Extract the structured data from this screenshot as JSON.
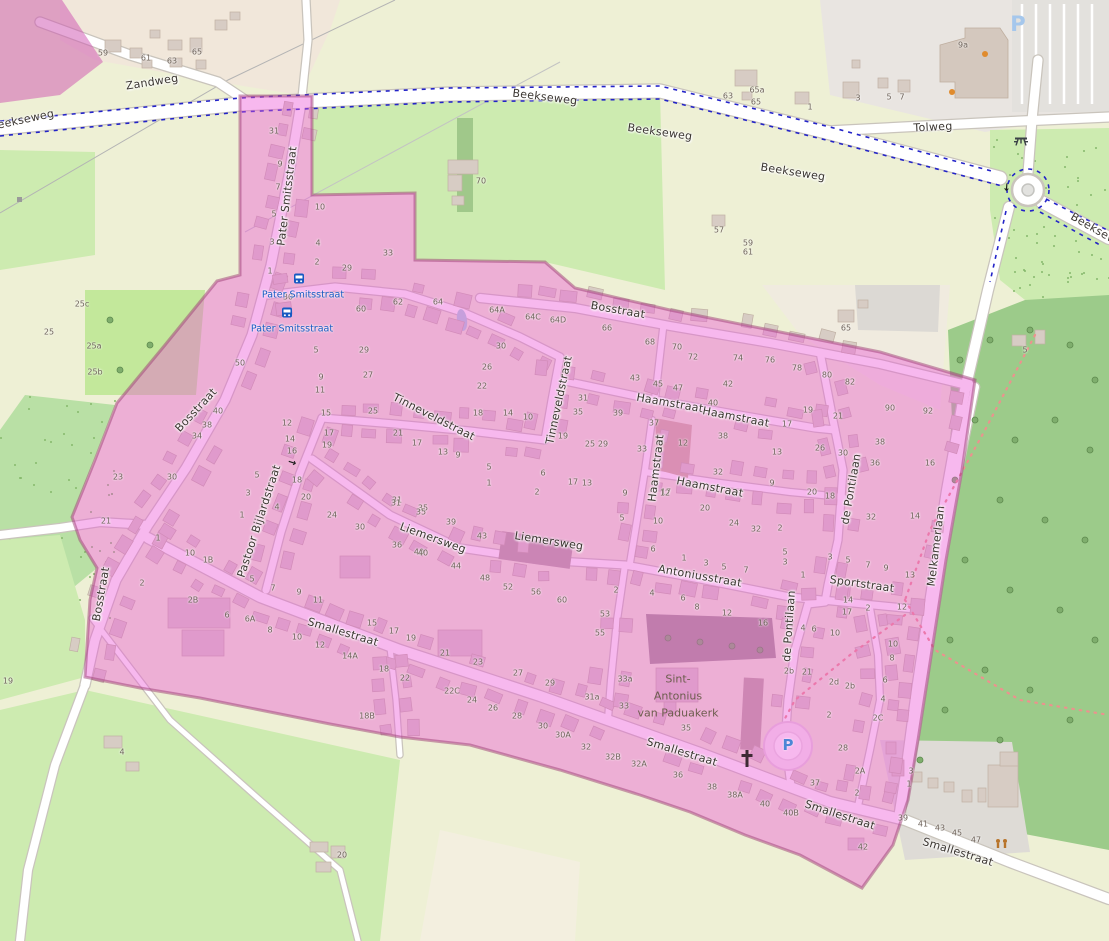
{
  "map": {
    "title": "Village map with highlighted boundary",
    "colors": {
      "pink_overlay": "rgba(235,85,215,0.42)",
      "pink_boundary": "rgba(158,62,118,0.5)",
      "forest": "#9ccb8a",
      "meadow": "#cdebb0",
      "farmland": "#eef0d5",
      "farmyard": "#f1e7da",
      "road_casing": "#c9c4bc",
      "building": "#d7ccc4",
      "building_line": "#c0b1a4",
      "water": "#abd4e0",
      "cycleway_blue": "#2323c8",
      "transit_blue": "#1659c2",
      "trail_red": "#ec928e",
      "poi_orange": "#e08b2d"
    },
    "street_labels": [
      {
        "text": "Zandweg",
        "x": 152,
        "y": 82,
        "r": -9
      },
      {
        "text": "Beekseweg",
        "x": 22,
        "y": 120,
        "r": -12
      },
      {
        "text": "Beekseweg",
        "x": 545,
        "y": 97,
        "r": 7
      },
      {
        "text": "Beekseweg",
        "x": 660,
        "y": 132,
        "r": 8
      },
      {
        "text": "Beekseweg",
        "x": 793,
        "y": 172,
        "r": 9
      },
      {
        "text": "Beekseweg",
        "x": 1100,
        "y": 232,
        "r": 30
      },
      {
        "text": "Tolweg",
        "x": 933,
        "y": 127,
        "r": -3
      },
      {
        "text": "Pater Smitsstraat",
        "x": 287,
        "y": 196,
        "r": -83
      },
      {
        "text": "Bosstraat",
        "x": 196,
        "y": 410,
        "r": -47
      },
      {
        "text": "Bosstraat",
        "x": 101,
        "y": 594,
        "r": -80
      },
      {
        "text": "Bosstraat",
        "x": 618,
        "y": 310,
        "r": 10
      },
      {
        "text": "Tinneveldstraat",
        "x": 434,
        "y": 417,
        "r": 27
      },
      {
        "text": "Tinneveldstraat",
        "x": 559,
        "y": 400,
        "r": -78
      },
      {
        "text": "Haamstraat",
        "x": 670,
        "y": 403,
        "r": 10
      },
      {
        "text": "Haamstraat",
        "x": 736,
        "y": 417,
        "r": 11
      },
      {
        "text": "Haamstraat",
        "x": 656,
        "y": 468,
        "r": -83
      },
      {
        "text": "Haamstraat",
        "x": 710,
        "y": 487,
        "r": 11
      },
      {
        "text": "Liemersweg",
        "x": 433,
        "y": 538,
        "r": 20
      },
      {
        "text": "Liemersweg",
        "x": 549,
        "y": 541,
        "r": 9
      },
      {
        "text": "Antoniusstraat",
        "x": 700,
        "y": 576,
        "r": 10
      },
      {
        "text": "Sportstraat",
        "x": 862,
        "y": 584,
        "r": 8
      },
      {
        "text": "de Pontilaan",
        "x": 851,
        "y": 489,
        "r": -80
      },
      {
        "text": "de Pontilaan",
        "x": 789,
        "y": 626,
        "r": -86
      },
      {
        "text": "Melkamerlaan",
        "x": 936,
        "y": 546,
        "r": -83
      },
      {
        "text": "Pastoor Bijlardstraat",
        "x": 259,
        "y": 521,
        "r": -72
      },
      {
        "text": "Smallestraat",
        "x": 343,
        "y": 632,
        "r": 17
      },
      {
        "text": "Smallestraat",
        "x": 682,
        "y": 752,
        "r": 17
      },
      {
        "text": "Smallestraat",
        "x": 840,
        "y": 815,
        "r": 18
      },
      {
        "text": "Smallestraat",
        "x": 958,
        "y": 852,
        "r": 17
      }
    ],
    "transit_stops": [
      {
        "label": "Pater Smitsstraat",
        "x": 303,
        "y": 295,
        "icon_x": 299,
        "icon_y": 280
      },
      {
        "label": "Pater Smitsstraat",
        "x": 292,
        "y": 329,
        "icon_x": 287,
        "icon_y": 314
      }
    ],
    "church_label": {
      "lines": [
        "Sint-",
        "Antonius",
        "van Paduakerk"
      ],
      "x": 678,
      "y": 696
    },
    "icons": [
      {
        "type": "parking-circle-p",
        "x": 788,
        "y": 745
      },
      {
        "type": "parking-area-p",
        "x": 1018,
        "y": 24
      },
      {
        "type": "church-cross",
        "x": 747,
        "y": 760
      },
      {
        "type": "picnic-table",
        "x": 1021,
        "y": 142
      },
      {
        "type": "playground",
        "x": 1002,
        "y": 845
      },
      {
        "type": "oneway-arrow",
        "x": 292,
        "y": 463,
        "r": 18
      },
      {
        "type": "oneway-arrow",
        "x": 1006,
        "y": 187,
        "r": 95
      }
    ],
    "house_numbers": [
      [
        "59",
        103,
        53
      ],
      [
        "61",
        146,
        58
      ],
      [
        "63",
        172,
        61
      ],
      [
        "65",
        197,
        52
      ],
      [
        "70",
        481,
        181
      ],
      [
        "63",
        728,
        96
      ],
      [
        "57",
        719,
        230
      ],
      [
        "59",
        748,
        243
      ],
      [
        "61",
        748,
        252
      ],
      [
        "65a",
        757,
        90
      ],
      [
        "65",
        756,
        102
      ],
      [
        "1",
        810,
        107
      ],
      [
        "3",
        858,
        98
      ],
      [
        "5",
        889,
        97
      ],
      [
        "7",
        902,
        97
      ],
      [
        "9a",
        963,
        45
      ],
      [
        "25c",
        82,
        304
      ],
      [
        "25",
        49,
        332
      ],
      [
        "25a",
        94,
        346
      ],
      [
        "25b",
        95,
        372
      ],
      [
        "65",
        846,
        328
      ],
      [
        "5",
        1025,
        350
      ],
      [
        "4",
        122,
        752
      ],
      [
        "20",
        342,
        855
      ],
      [
        "19",
        8,
        681
      ],
      [
        "39",
        903,
        818
      ],
      [
        "41",
        923,
        824
      ],
      [
        "43",
        940,
        828
      ],
      [
        "45",
        957,
        833
      ],
      [
        "47",
        976,
        840
      ],
      [
        "3",
        911,
        771
      ],
      [
        "1",
        909,
        784
      ],
      [
        "42",
        863,
        847
      ],
      [
        "31",
        274,
        131
      ],
      [
        "9",
        280,
        164
      ],
      [
        "7",
        278,
        187
      ],
      [
        "5",
        274,
        214
      ],
      [
        "3",
        272,
        242
      ],
      [
        "1",
        270,
        271
      ],
      [
        "10",
        320,
        207
      ],
      [
        "4",
        318,
        243
      ],
      [
        "2",
        317,
        262
      ],
      [
        "29",
        347,
        268
      ],
      [
        "33",
        388,
        253
      ],
      [
        "30",
        288,
        297
      ],
      [
        "60",
        361,
        309
      ],
      [
        "62",
        398,
        302
      ],
      [
        "64",
        438,
        302
      ],
      [
        "64A",
        497,
        310
      ],
      [
        "64C",
        533,
        317
      ],
      [
        "64D",
        558,
        320
      ],
      [
        "66",
        607,
        328
      ],
      [
        "68",
        650,
        342
      ],
      [
        "70",
        677,
        347
      ],
      [
        "72",
        693,
        357
      ],
      [
        "74",
        738,
        358
      ],
      [
        "5",
        316,
        350
      ],
      [
        "29",
        364,
        350
      ],
      [
        "27",
        368,
        375
      ],
      [
        "9",
        321,
        377
      ],
      [
        "11",
        320,
        390
      ],
      [
        "15",
        326,
        413
      ],
      [
        "25",
        373,
        411
      ],
      [
        "12",
        287,
        423
      ],
      [
        "14",
        290,
        439
      ],
      [
        "16",
        292,
        451
      ],
      [
        "17",
        329,
        433
      ],
      [
        "19",
        327,
        445
      ],
      [
        "30",
        501,
        346
      ],
      [
        "26",
        487,
        367
      ],
      [
        "22",
        482,
        386
      ],
      [
        "18",
        478,
        413
      ],
      [
        "14",
        508,
        413
      ],
      [
        "10",
        528,
        417
      ],
      [
        "38",
        207,
        425
      ],
      [
        "34",
        197,
        436
      ],
      [
        "40",
        218,
        411
      ],
      [
        "50",
        240,
        363
      ],
      [
        "23",
        118,
        477
      ],
      [
        "21",
        106,
        521
      ],
      [
        "30",
        172,
        477
      ],
      [
        "43",
        635,
        378
      ],
      [
        "45",
        658,
        384
      ],
      [
        "47",
        678,
        388
      ],
      [
        "42",
        728,
        384
      ],
      [
        "40",
        713,
        403
      ],
      [
        "38",
        723,
        436
      ],
      [
        "32",
        718,
        472
      ],
      [
        "13",
        777,
        452
      ],
      [
        "9",
        772,
        483
      ],
      [
        "26",
        820,
        448
      ],
      [
        "30",
        843,
        453
      ],
      [
        "20",
        812,
        492
      ],
      [
        "18",
        830,
        496
      ],
      [
        "90",
        890,
        408
      ],
      [
        "92",
        928,
        411
      ],
      [
        "38",
        880,
        442
      ],
      [
        "36",
        875,
        463
      ],
      [
        "16",
        930,
        463
      ],
      [
        "12",
        683,
        443
      ],
      [
        "31",
        583,
        398
      ],
      [
        "35",
        578,
        412
      ],
      [
        "39",
        618,
        413
      ],
      [
        "37",
        654,
        423
      ],
      [
        "33",
        642,
        449
      ],
      [
        "29",
        603,
        444
      ],
      [
        "25",
        590,
        444
      ],
      [
        "19",
        563,
        436
      ],
      [
        "17",
        573,
        482
      ],
      [
        "13",
        587,
        483
      ],
      [
        "9",
        458,
        455
      ],
      [
        "13",
        443,
        452
      ],
      [
        "5",
        489,
        467
      ],
      [
        "1",
        489,
        483
      ],
      [
        "6",
        543,
        473
      ],
      [
        "17",
        417,
        443
      ],
      [
        "21",
        398,
        433
      ],
      [
        "76",
        770,
        360
      ],
      [
        "78",
        797,
        368
      ],
      [
        "80",
        827,
        375
      ],
      [
        "82",
        850,
        382
      ],
      [
        "19",
        808,
        410
      ],
      [
        "21",
        838,
        416
      ],
      [
        "17",
        787,
        424
      ],
      [
        "31",
        397,
        500
      ],
      [
        "35",
        423,
        508
      ],
      [
        "18",
        297,
        480
      ],
      [
        "20",
        306,
        497
      ],
      [
        "24",
        332,
        515
      ],
      [
        "30",
        360,
        527
      ],
      [
        "36",
        397,
        545
      ],
      [
        "40",
        419,
        552
      ],
      [
        "5",
        257,
        475
      ],
      [
        "3",
        248,
        493
      ],
      [
        "4",
        277,
        507
      ],
      [
        "1",
        242,
        515
      ],
      [
        "10",
        190,
        553
      ],
      [
        "1B",
        208,
        560
      ],
      [
        "2",
        142,
        583
      ],
      [
        "2B",
        193,
        600
      ],
      [
        "1",
        158,
        538
      ],
      [
        "17",
        666,
        492
      ],
      [
        "20",
        705,
        508
      ],
      [
        "10",
        658,
        521
      ],
      [
        "24",
        734,
        523
      ],
      [
        "32",
        756,
        529
      ],
      [
        "31",
        396,
        503
      ],
      [
        "35",
        421,
        512
      ],
      [
        "39",
        451,
        522
      ],
      [
        "43",
        482,
        536
      ],
      [
        "40",
        423,
        553
      ],
      [
        "44",
        456,
        566
      ],
      [
        "48",
        485,
        578
      ],
      [
        "52",
        508,
        587
      ],
      [
        "56",
        536,
        592
      ],
      [
        "60",
        562,
        600
      ],
      [
        "2",
        537,
        492
      ],
      [
        "9",
        625,
        493
      ],
      [
        "5",
        622,
        518
      ],
      [
        "12",
        665,
        493
      ],
      [
        "6",
        653,
        549
      ],
      [
        "1",
        684,
        558
      ],
      [
        "3",
        706,
        563
      ],
      [
        "5",
        724,
        567
      ],
      [
        "7",
        746,
        570
      ],
      [
        "1",
        803,
        575
      ],
      [
        "2",
        780,
        528
      ],
      [
        "5",
        785,
        552
      ],
      [
        "3",
        785,
        562
      ],
      [
        "2",
        616,
        590
      ],
      [
        "4",
        652,
        593
      ],
      [
        "6",
        683,
        598
      ],
      [
        "8",
        697,
        607
      ],
      [
        "53",
        605,
        614
      ],
      [
        "55",
        600,
        633
      ],
      [
        "33a",
        625,
        679
      ],
      [
        "31a",
        592,
        697
      ],
      [
        "33",
        624,
        706
      ],
      [
        "35",
        686,
        728
      ],
      [
        "12",
        727,
        613
      ],
      [
        "16",
        763,
        623
      ],
      [
        "3",
        830,
        557
      ],
      [
        "5",
        848,
        560
      ],
      [
        "7",
        868,
        565
      ],
      [
        "9",
        886,
        568
      ],
      [
        "13",
        910,
        575
      ],
      [
        "14",
        848,
        600
      ],
      [
        "17",
        847,
        612
      ],
      [
        "2",
        868,
        608
      ],
      [
        "12",
        902,
        607
      ],
      [
        "4",
        803,
        628
      ],
      [
        "6",
        814,
        629
      ],
      [
        "10",
        835,
        633
      ],
      [
        "10",
        893,
        644
      ],
      [
        "8",
        892,
        658
      ],
      [
        "6",
        885,
        680
      ],
      [
        "4",
        883,
        699
      ],
      [
        "14",
        915,
        516
      ],
      [
        "32",
        871,
        517
      ],
      [
        "2b",
        789,
        671
      ],
      [
        "21",
        807,
        672
      ],
      [
        "2d",
        834,
        682
      ],
      [
        "2b",
        850,
        686
      ],
      [
        "2",
        829,
        715
      ],
      [
        "2C",
        878,
        718
      ],
      [
        "28",
        843,
        748
      ],
      [
        "2A",
        860,
        771
      ],
      [
        "2",
        857,
        793
      ],
      [
        "37",
        815,
        783
      ],
      [
        "5",
        252,
        579
      ],
      [
        "7",
        273,
        588
      ],
      [
        "9",
        299,
        592
      ],
      [
        "11",
        318,
        600
      ],
      [
        "15",
        372,
        623
      ],
      [
        "17",
        394,
        631
      ],
      [
        "19",
        411,
        638
      ],
      [
        "21",
        445,
        653
      ],
      [
        "23",
        478,
        662
      ],
      [
        "27",
        518,
        673
      ],
      [
        "29",
        550,
        683
      ],
      [
        "6",
        227,
        615
      ],
      [
        "6A",
        250,
        619
      ],
      [
        "8",
        270,
        630
      ],
      [
        "10",
        297,
        637
      ],
      [
        "12",
        320,
        645
      ],
      [
        "14A",
        350,
        656
      ],
      [
        "18",
        384,
        669
      ],
      [
        "22",
        405,
        678
      ],
      [
        "22C",
        452,
        691
      ],
      [
        "24",
        472,
        700
      ],
      [
        "26",
        493,
        708
      ],
      [
        "28",
        517,
        716
      ],
      [
        "30",
        543,
        726
      ],
      [
        "30A",
        563,
        735
      ],
      [
        "32",
        586,
        747
      ],
      [
        "18B",
        367,
        716
      ],
      [
        "32B",
        613,
        757
      ],
      [
        "32A",
        639,
        764
      ],
      [
        "36",
        678,
        775
      ],
      [
        "38",
        712,
        787
      ],
      [
        "38A",
        735,
        795
      ],
      [
        "40",
        765,
        804
      ],
      [
        "40B",
        791,
        813
      ]
    ]
  }
}
